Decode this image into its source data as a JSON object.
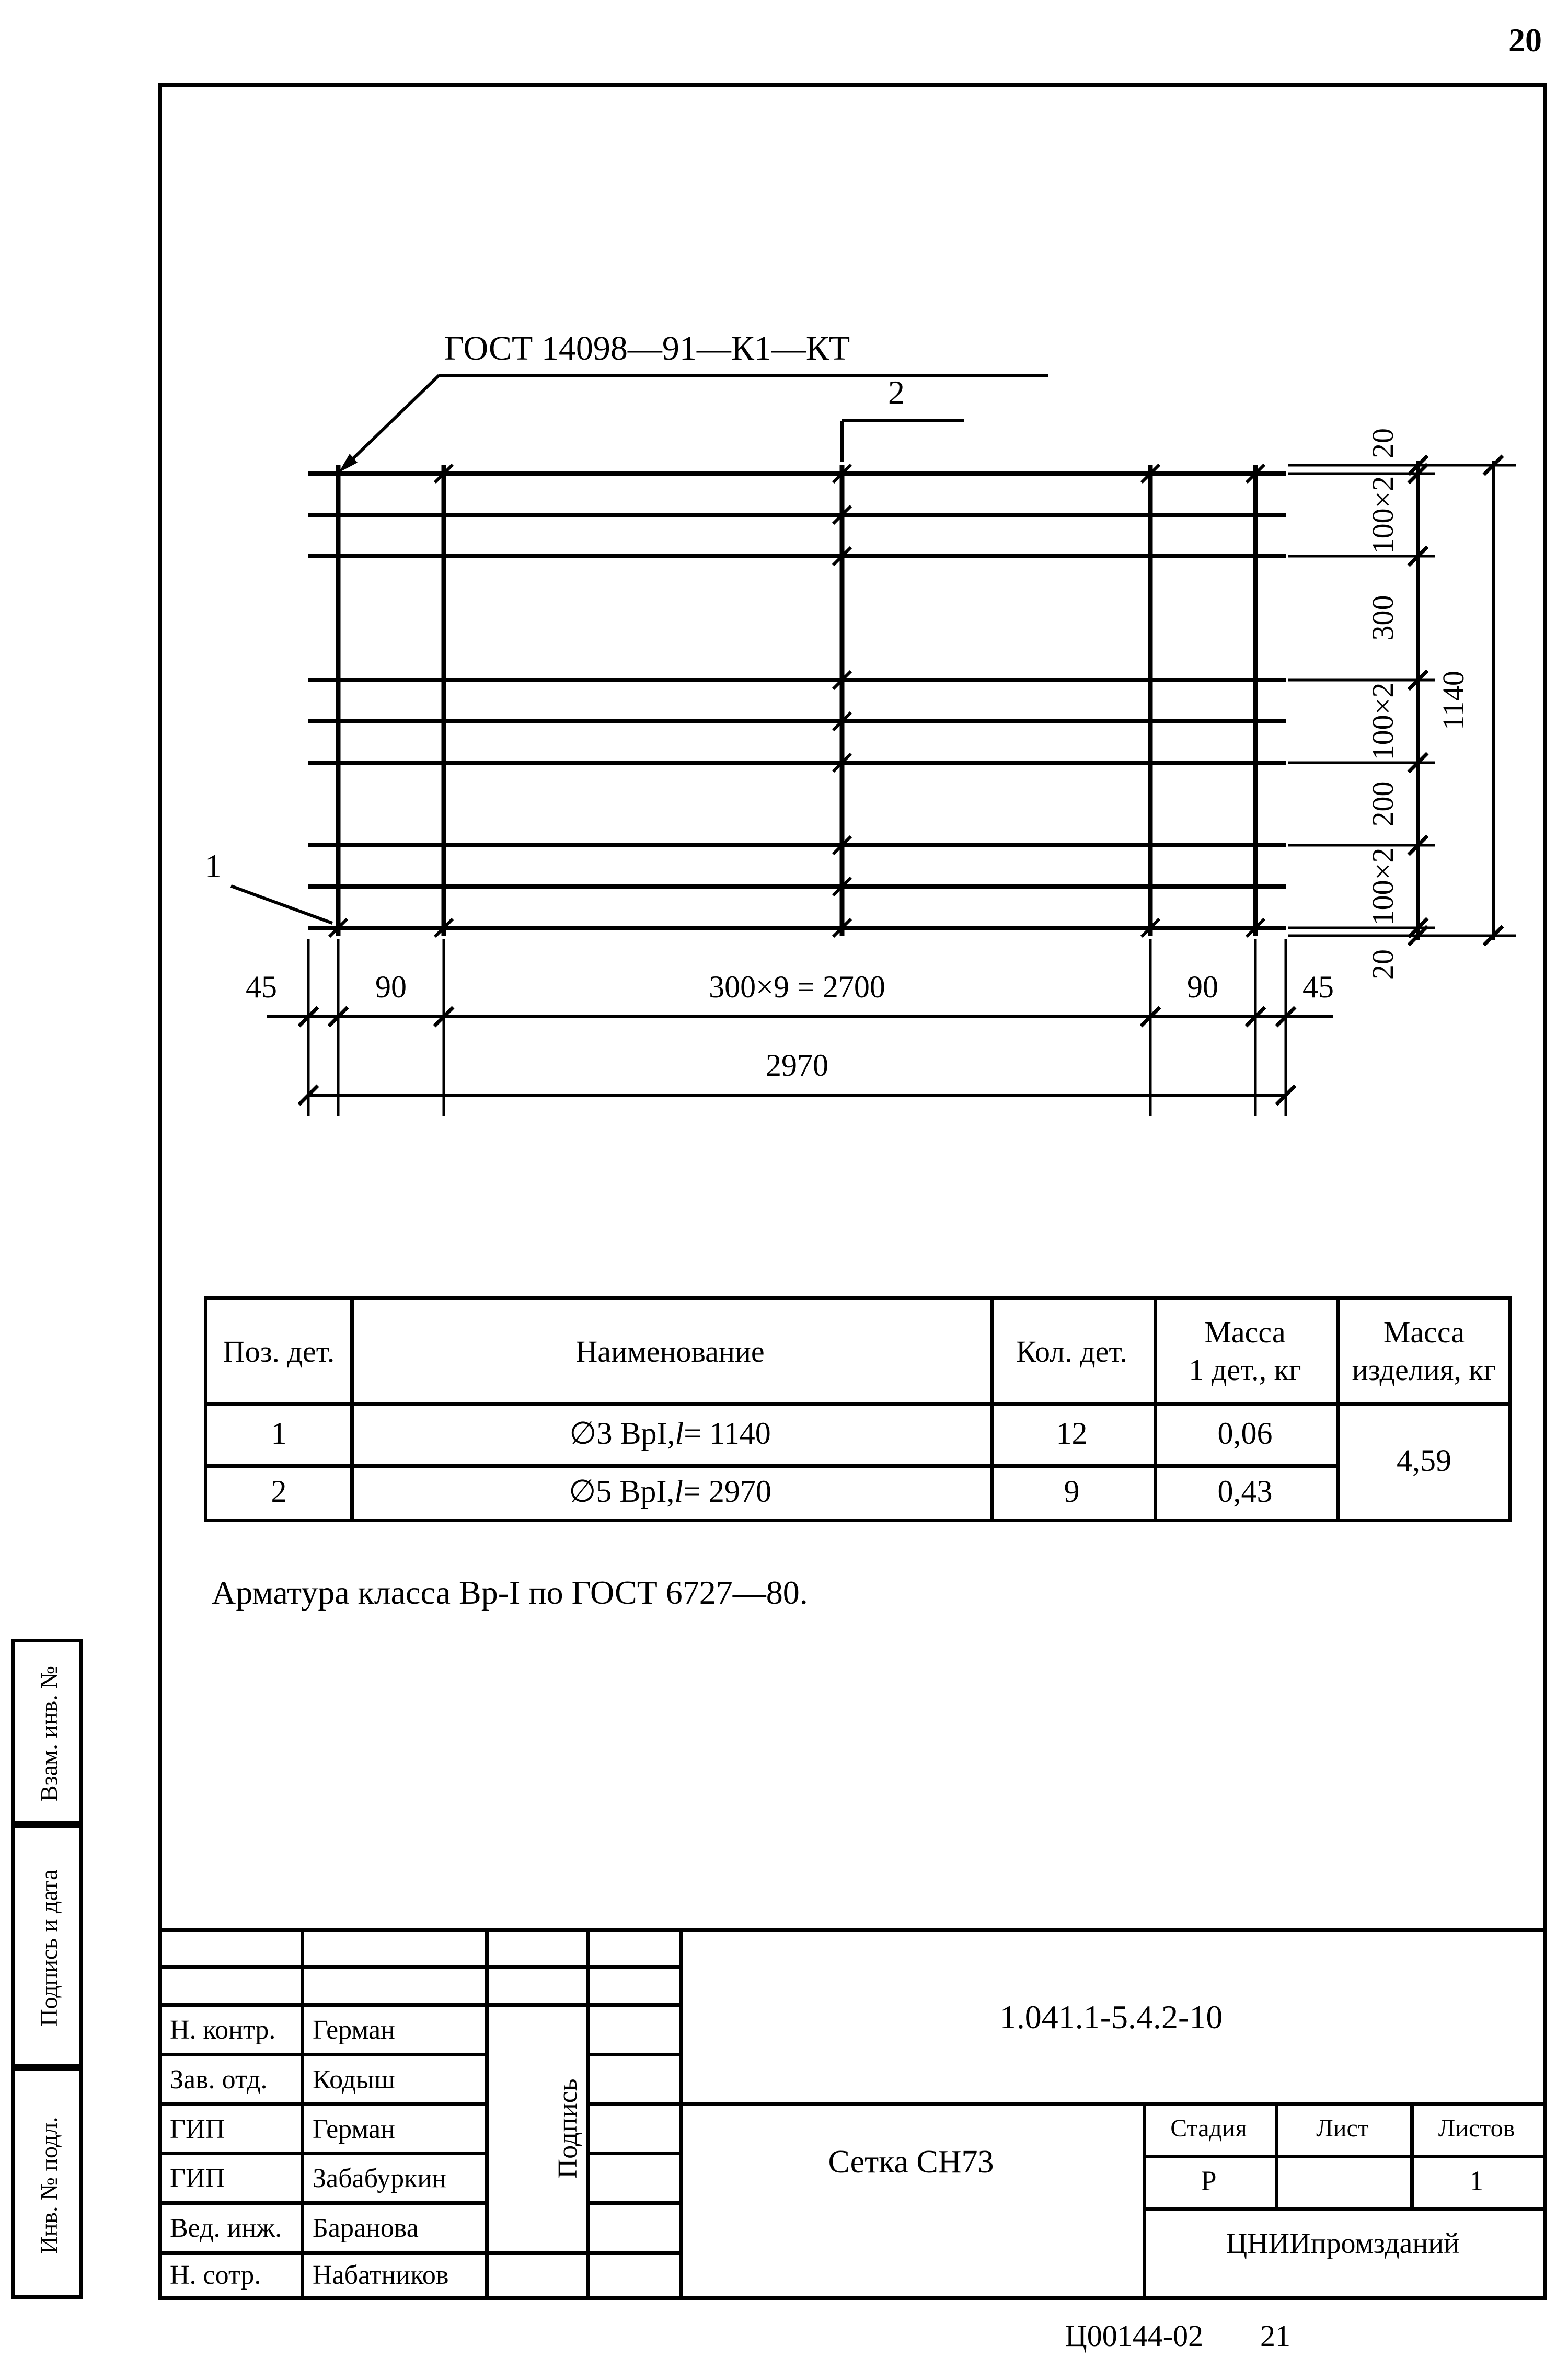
{
  "page": {
    "number": "20",
    "footer_code": "Ц00144-02",
    "footer_page": "21"
  },
  "drawing": {
    "weld_label": "ГОСТ 14098—91—К1—КТ",
    "pos_1": "1",
    "pos_2": "2",
    "dims_bottom": [
      "45",
      "90",
      "300×9 = 2700",
      "90",
      "45"
    ],
    "dim_total_width": "2970",
    "dims_right": [
      "20",
      "100×2",
      "300",
      "100×2",
      "200",
      "100×2",
      "20"
    ],
    "dim_total_height": "1140"
  },
  "table": {
    "headers": [
      "Поз. дет.",
      "Наименование",
      "Кол. дет.",
      "Масса\n1 дет., кг",
      "Масса\nизделия, кг"
    ],
    "rows": [
      {
        "pos": "1",
        "name_prefix": "∅3 ВрI, ",
        "name_var": "l",
        "name_value": " = 1140",
        "qty": "12",
        "mass": "0,06"
      },
      {
        "pos": "2",
        "name_prefix": "∅5 ВрI, ",
        "name_var": "l",
        "name_value": " = 2970",
        "qty": "9",
        "mass": "0,43"
      }
    ],
    "total_mass": "4,59"
  },
  "note": "Арматура класса Вр-I по ГОСТ 6727—80.",
  "sidebar": {
    "items": [
      "Взам. инв. №",
      "Подпись и дата",
      "Инв. № подл."
    ]
  },
  "stamp": {
    "rows": [
      {
        "role": "Н. контр.",
        "name": "Герман"
      },
      {
        "role": "Зав. отд.",
        "name": "Кодыш"
      },
      {
        "role": "ГИП",
        "name": "Герман"
      },
      {
        "role": "ГИП",
        "name": "Забабуркин"
      },
      {
        "role": "Вед. инж.",
        "name": "Баранова"
      },
      {
        "role": "Н. сотр.",
        "name": "Набатников"
      }
    ],
    "signature_column_label": "Подпись",
    "doc_number": "1.041.1-5.4.2-10",
    "product_title": "Сетка СН73",
    "stage_headers": [
      "Стадия",
      "Лист",
      "Листов"
    ],
    "stage_value": "Р",
    "sheets_value": "1",
    "organization": "ЦНИИпромзданий"
  }
}
